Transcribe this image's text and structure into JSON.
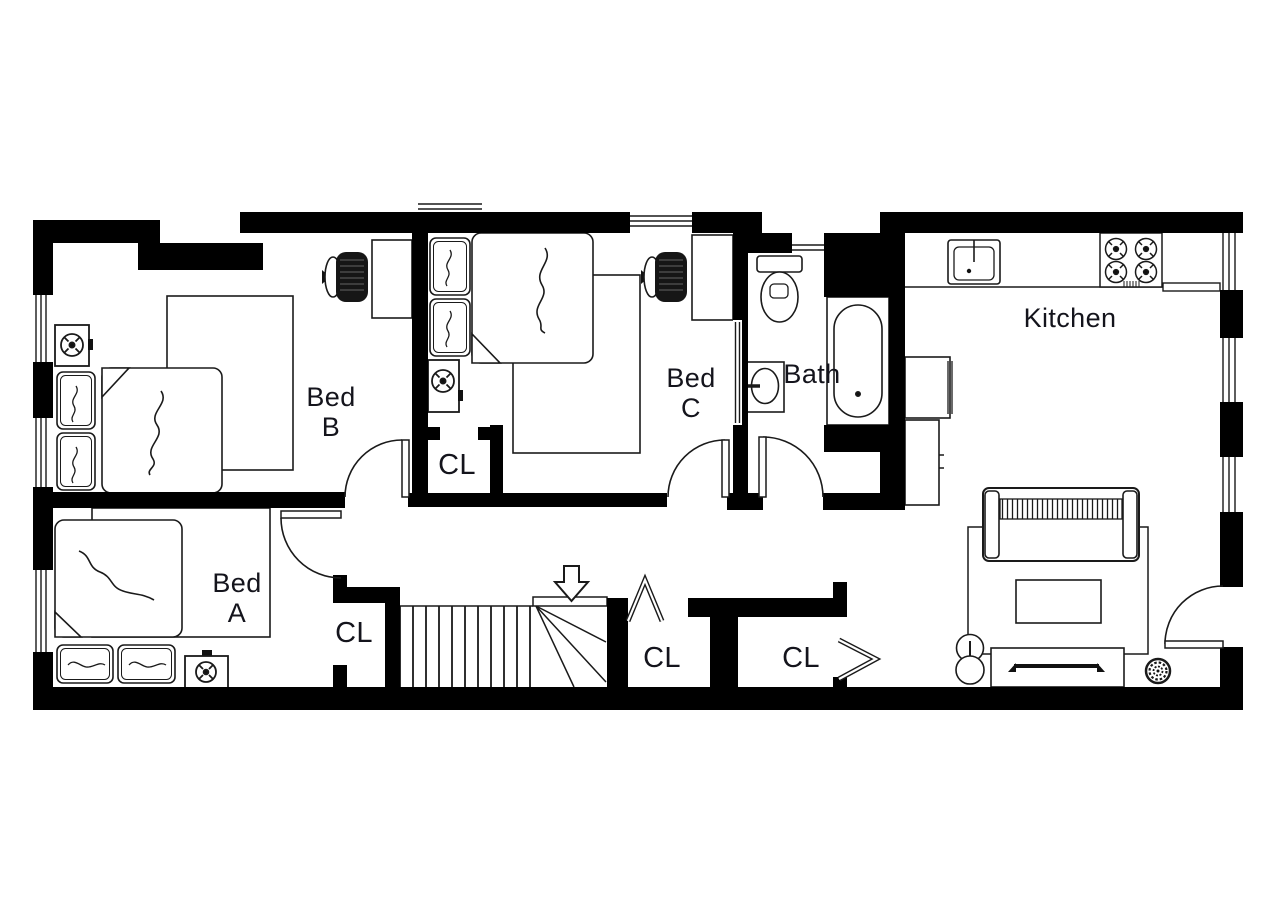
{
  "meta": {
    "background": "#ffffff",
    "wall_color": "#000000",
    "line_color": "#1a1a1a",
    "label_color": "#14141c"
  },
  "rooms": {
    "bed_b": {
      "line1": "Bed",
      "line2": "B"
    },
    "bed_a": {
      "line1": "Bed",
      "line2": "A"
    },
    "bed_c": {
      "line1": "Bed",
      "line2": "C"
    },
    "bath": {
      "label": "Bath"
    },
    "kitchen": {
      "label": "Kitchen"
    }
  },
  "closets": {
    "upper": "CL",
    "bed_a": "CL",
    "stairs": "CL",
    "hall": "CL"
  },
  "symbols": {
    "stairs_arrow": "stairs-down-arrow-icon",
    "ceiling_fixture": "ceiling-fan-icon",
    "bifold": "bifold-door-icon"
  }
}
